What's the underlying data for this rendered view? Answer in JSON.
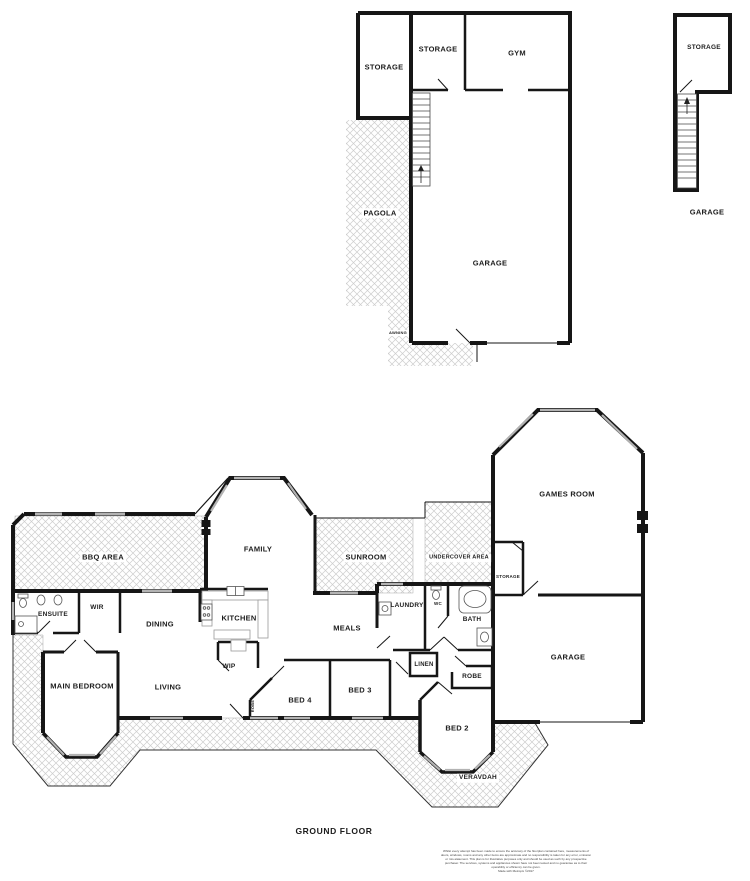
{
  "colors": {
    "wall": "#161616",
    "window": "#b3b3b3",
    "hatch_line": "#cdcdcd",
    "fixture": "#555555"
  },
  "upper_level": {
    "storage_left": "STORAGE",
    "storage_mid": "STORAGE",
    "gym": "GYM",
    "pagola": "PAGOLA",
    "garage": "GARAGE",
    "awning": "AWNING"
  },
  "upper_right_building": {
    "storage": "STORAGE",
    "caption": "GARAGE"
  },
  "ground_level": {
    "bbq_area": "BBQ AREA",
    "ensuite": "ENSUITE",
    "wir": "WIR",
    "dining": "DINING",
    "kitchen": "KITCHEN",
    "family": "FAMILY",
    "sunroom": "SUNROOM",
    "undercover_area": "UNDERCOVER AREA",
    "storage_small": "STORAGE",
    "games_room": "GAMES ROOM",
    "garage": "GARAGE",
    "laundry": "LAUNDRY",
    "wc": "WC",
    "bath": "BATH",
    "meals": "MEALS",
    "wip": "WIP",
    "main_bedroom": "MAIN BEDROOM",
    "living": "LIVING",
    "robe_small": "ROBE",
    "bed4": "BED 4",
    "bed3": "BED 3",
    "linen": "LINEN",
    "robe": "ROBE",
    "bed2": "BED 2",
    "verandah": "VERAVDAH"
  },
  "footer": {
    "caption": "GROUND FLOOR",
    "disclaimer": "Whilst every attempt has been made to ensure the accuracy of the floorplan contained here, measurements of doors, windows, rooms and any other items are approximate and no responsibility is taken for any error, omission or mis-statement. This plan is for illustrative purposes only and should be used as such by any prospective purchaser. The services, systems and appliances shown have not been tested and no guarantee as to their operability or efficiency can be given.",
    "credit": "Made with Metropix ©2017"
  }
}
